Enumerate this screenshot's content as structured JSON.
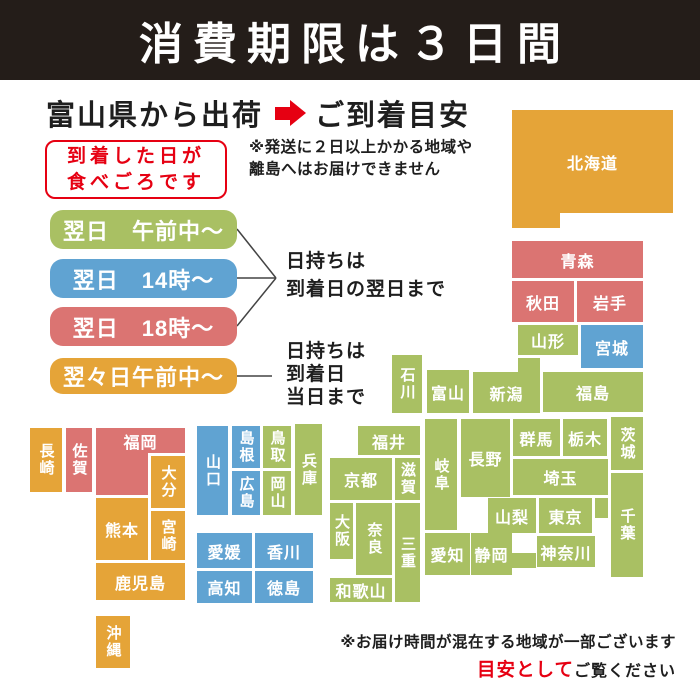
{
  "banner": {
    "title": "消費期限は３日間"
  },
  "header": {
    "from": "富山県から出荷",
    "to": "ご到着目安"
  },
  "eat_day_box": {
    "line1": "到着した日が",
    "line2": "食べごろです"
  },
  "shipping_note": {
    "line1": "※発送に２日以上かかる地域や",
    "line2": "離島へはお届けできません"
  },
  "legend": {
    "items": [
      {
        "key": "green",
        "label": "翌日　午前中〜",
        "color": "#a9c063"
      },
      {
        "key": "blue",
        "label": "翌日　14時〜",
        "color": "#60a3d2"
      },
      {
        "key": "red",
        "label": "翌日　18時〜",
        "color": "#db7472"
      },
      {
        "key": "orange",
        "label": "翌々日午前中〜",
        "color": "#e5a438"
      }
    ],
    "note_next_day": {
      "line1": "日持ちは",
      "line2": "到着日の翌日まで"
    },
    "note_same_day": {
      "line1": "日持ちは",
      "line2": "到着日",
      "line3": "当日まで"
    }
  },
  "map": {
    "colors": {
      "green": "#a9c063",
      "blue": "#60a3d2",
      "red": "#db7472",
      "orange": "#e5a438"
    },
    "prefectures": [
      {
        "id": "hokkaido",
        "label": "北海道",
        "color": "orange",
        "x": 512,
        "y": 110,
        "w": 161,
        "h": 103
      },
      {
        "id": "hokkaido-tab",
        "label": "",
        "color": "orange",
        "x": 512,
        "y": 211,
        "w": 48,
        "h": 17
      },
      {
        "id": "aomori",
        "label": "青森",
        "color": "red",
        "x": 512,
        "y": 241,
        "w": 131,
        "h": 37
      },
      {
        "id": "akita",
        "label": "秋田",
        "color": "red",
        "x": 512,
        "y": 281,
        "w": 62,
        "h": 41
      },
      {
        "id": "iwate",
        "label": "岩手",
        "color": "red",
        "x": 577,
        "y": 281,
        "w": 66,
        "h": 41
      },
      {
        "id": "yamagata",
        "label": "山形",
        "color": "green",
        "x": 518,
        "y": 325,
        "w": 60,
        "h": 30
      },
      {
        "id": "miyagi",
        "label": "宮城",
        "color": "blue",
        "x": 581,
        "y": 325,
        "w": 62,
        "h": 43
      },
      {
        "id": "niigata-tab",
        "label": "",
        "color": "green",
        "x": 518,
        "y": 358,
        "w": 22,
        "h": 16
      },
      {
        "id": "niigata",
        "label": "新潟",
        "color": "green",
        "x": 473,
        "y": 372,
        "w": 67,
        "h": 41
      },
      {
        "id": "fukushima",
        "label": "福島",
        "color": "green",
        "x": 543,
        "y": 372,
        "w": 100,
        "h": 40
      },
      {
        "id": "toyama",
        "label": "富山",
        "color": "green",
        "x": 427,
        "y": 370,
        "w": 42,
        "h": 43
      },
      {
        "id": "ishikawa",
        "label": "石川",
        "color": "green",
        "x": 392,
        "y": 355,
        "w": 30,
        "h": 58,
        "vertical": true
      },
      {
        "id": "fukui",
        "label": "福井",
        "color": "green",
        "x": 358,
        "y": 426,
        "w": 62,
        "h": 29
      },
      {
        "id": "gifu",
        "label": "岐阜",
        "color": "green",
        "x": 425,
        "y": 419,
        "w": 32,
        "h": 111,
        "vertical": true
      },
      {
        "id": "nagano",
        "label": "長野",
        "color": "green",
        "x": 461,
        "y": 419,
        "w": 49,
        "h": 78
      },
      {
        "id": "gunma",
        "label": "群馬",
        "color": "green",
        "x": 513,
        "y": 419,
        "w": 47,
        "h": 37
      },
      {
        "id": "tochigi",
        "label": "栃木",
        "color": "green",
        "x": 563,
        "y": 419,
        "w": 44,
        "h": 37
      },
      {
        "id": "ibaraki",
        "label": "茨城",
        "color": "green",
        "x": 611,
        "y": 417,
        "w": 32,
        "h": 53,
        "vertical": true
      },
      {
        "id": "saitama",
        "label": "埼玉",
        "color": "green",
        "x": 513,
        "y": 459,
        "w": 95,
        "h": 36
      },
      {
        "id": "yamanashi",
        "label": "山梨",
        "color": "green",
        "x": 488,
        "y": 498,
        "w": 48,
        "h": 35
      },
      {
        "id": "tokyo",
        "label": "東京",
        "color": "green",
        "x": 539,
        "y": 498,
        "w": 53,
        "h": 35
      },
      {
        "id": "tokyo-ext",
        "label": "",
        "color": "green",
        "x": 595,
        "y": 498,
        "w": 13,
        "h": 20
      },
      {
        "id": "chiba",
        "label": "千葉",
        "color": "green",
        "x": 611,
        "y": 473,
        "w": 32,
        "h": 104,
        "vertical": true
      },
      {
        "id": "kanagawa",
        "label": "神奈川",
        "color": "green",
        "x": 537,
        "y": 536,
        "w": 58,
        "h": 31
      },
      {
        "id": "shizuoka",
        "label": "静岡",
        "color": "green",
        "x": 471,
        "y": 533,
        "w": 41,
        "h": 42
      },
      {
        "id": "shizuoka-ext",
        "label": "",
        "color": "green",
        "x": 512,
        "y": 553,
        "w": 24,
        "h": 15
      },
      {
        "id": "aichi",
        "label": "愛知",
        "color": "green",
        "x": 425,
        "y": 533,
        "w": 45,
        "h": 42
      },
      {
        "id": "kyoto",
        "label": "京都",
        "color": "green",
        "x": 330,
        "y": 458,
        "w": 62,
        "h": 42
      },
      {
        "id": "shiga",
        "label": "滋賀",
        "color": "green",
        "x": 395,
        "y": 458,
        "w": 25,
        "h": 42,
        "vertical": true
      },
      {
        "id": "osaka",
        "label": "大阪",
        "color": "green",
        "x": 330,
        "y": 503,
        "w": 23,
        "h": 56,
        "vertical": true
      },
      {
        "id": "nara",
        "label": "奈良",
        "color": "green",
        "x": 356,
        "y": 503,
        "w": 36,
        "h": 72,
        "vertical": true
      },
      {
        "id": "mie",
        "label": "三重",
        "color": "green",
        "x": 395,
        "y": 503,
        "w": 25,
        "h": 99,
        "vertical": true
      },
      {
        "id": "wakayama",
        "label": "和歌山",
        "color": "green",
        "x": 330,
        "y": 578,
        "w": 62,
        "h": 24
      },
      {
        "id": "hyogo",
        "label": "兵庫",
        "color": "green",
        "x": 295,
        "y": 424,
        "w": 27,
        "h": 91,
        "vertical": true
      },
      {
        "id": "tottori",
        "label": "鳥取",
        "color": "green",
        "x": 263,
        "y": 426,
        "w": 28,
        "h": 42,
        "vertical": true
      },
      {
        "id": "okayama",
        "label": "岡山",
        "color": "green",
        "x": 263,
        "y": 471,
        "w": 28,
        "h": 44,
        "vertical": true
      },
      {
        "id": "shimane",
        "label": "島根",
        "color": "blue",
        "x": 232,
        "y": 426,
        "w": 28,
        "h": 42,
        "vertical": true
      },
      {
        "id": "hiroshima",
        "label": "広島",
        "color": "blue",
        "x": 232,
        "y": 471,
        "w": 28,
        "h": 44,
        "vertical": true
      },
      {
        "id": "yamaguchi",
        "label": "山口",
        "color": "blue",
        "x": 197,
        "y": 426,
        "w": 31,
        "h": 89,
        "vertical": true
      },
      {
        "id": "ehime",
        "label": "愛媛",
        "color": "blue",
        "x": 197,
        "y": 533,
        "w": 55,
        "h": 35
      },
      {
        "id": "kagawa",
        "label": "香川",
        "color": "blue",
        "x": 255,
        "y": 533,
        "w": 58,
        "h": 35
      },
      {
        "id": "kochi",
        "label": "高知",
        "color": "blue",
        "x": 197,
        "y": 571,
        "w": 55,
        "h": 32
      },
      {
        "id": "tokushima",
        "label": "徳島",
        "color": "blue",
        "x": 255,
        "y": 571,
        "w": 58,
        "h": 32
      },
      {
        "id": "nagasaki",
        "label": "長崎",
        "color": "orange",
        "x": 30,
        "y": 428,
        "w": 32,
        "h": 64,
        "vertical": true
      },
      {
        "id": "saga",
        "label": "佐賀",
        "color": "red",
        "x": 66,
        "y": 428,
        "w": 26,
        "h": 64,
        "vertical": true
      },
      {
        "id": "fukuoka-lower",
        "label": "",
        "color": "red",
        "x": 96,
        "y": 428,
        "w": 52,
        "h": 67
      },
      {
        "id": "fukuoka",
        "label": "福岡",
        "color": "red",
        "x": 96,
        "y": 428,
        "w": 89,
        "h": 25
      },
      {
        "id": "oita",
        "label": "大分",
        "color": "orange",
        "x": 151,
        "y": 456,
        "w": 34,
        "h": 52,
        "vertical": true
      },
      {
        "id": "kumamoto",
        "label": "熊本",
        "color": "orange",
        "x": 96,
        "y": 498,
        "w": 52,
        "h": 62
      },
      {
        "id": "miyazaki",
        "label": "宮崎",
        "color": "orange",
        "x": 151,
        "y": 511,
        "w": 34,
        "h": 49,
        "vertical": true
      },
      {
        "id": "kagoshima",
        "label": "鹿児島",
        "color": "orange",
        "x": 96,
        "y": 563,
        "w": 89,
        "h": 37
      },
      {
        "id": "okinawa",
        "label": "沖縄",
        "color": "orange",
        "x": 96,
        "y": 616,
        "w": 34,
        "h": 52,
        "vertical": true
      }
    ]
  },
  "footer": {
    "line1": "※お届け時間が混在する地域が一部ございます",
    "line2_red": "目安として",
    "line2_black": "ご覧ください"
  }
}
